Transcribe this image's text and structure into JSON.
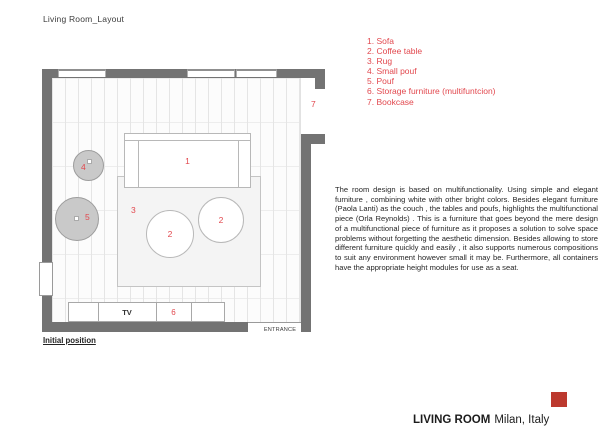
{
  "header": {
    "title": "Living Room_Layout"
  },
  "legend": {
    "items": [
      "1. Sofa",
      "2. Coffee table",
      "3. Rug",
      "4. Small pouf",
      "5. Pouf",
      "6. Storage furniture (multifuntcion)",
      "7. Bookcase"
    ]
  },
  "plan": {
    "numbers": {
      "sofa": "1",
      "coffee_table": "2",
      "rug": "3",
      "small_pouf": "4",
      "pouf": "5",
      "storage": "6",
      "bookcase": "7"
    },
    "tv_label": "TV",
    "entrance_label": "ENTRANCE",
    "caption": "Initial position"
  },
  "description": "The room design is based on multifunctionality. Using simple and elegant furniture , combining white with other bright colors. Besides elegant furniture (Paola Lanti) as the couch , the tables and poufs, highlights the multifunctional piece (Orla Reynolds) . This is a furniture that goes beyond the mere design of a multifunctional piece of furniture as it proposes a solution to solve space problems without forgetting the aesthetic dimension. Besides allowing to store different furniture quickly and easily , it also supports numerous compositions to suit any environment however small it may be. Furthermore, all containers have the appropriate height modules for use as a seat.",
  "footer": {
    "name": "LIVING ROOM",
    "location": "Milan, Italy"
  },
  "colors": {
    "accent_red": "#e2484e",
    "wall_gray": "#737373",
    "brand_square_red": "#bc392e",
    "pouf_fill": "#c9c9c9"
  }
}
